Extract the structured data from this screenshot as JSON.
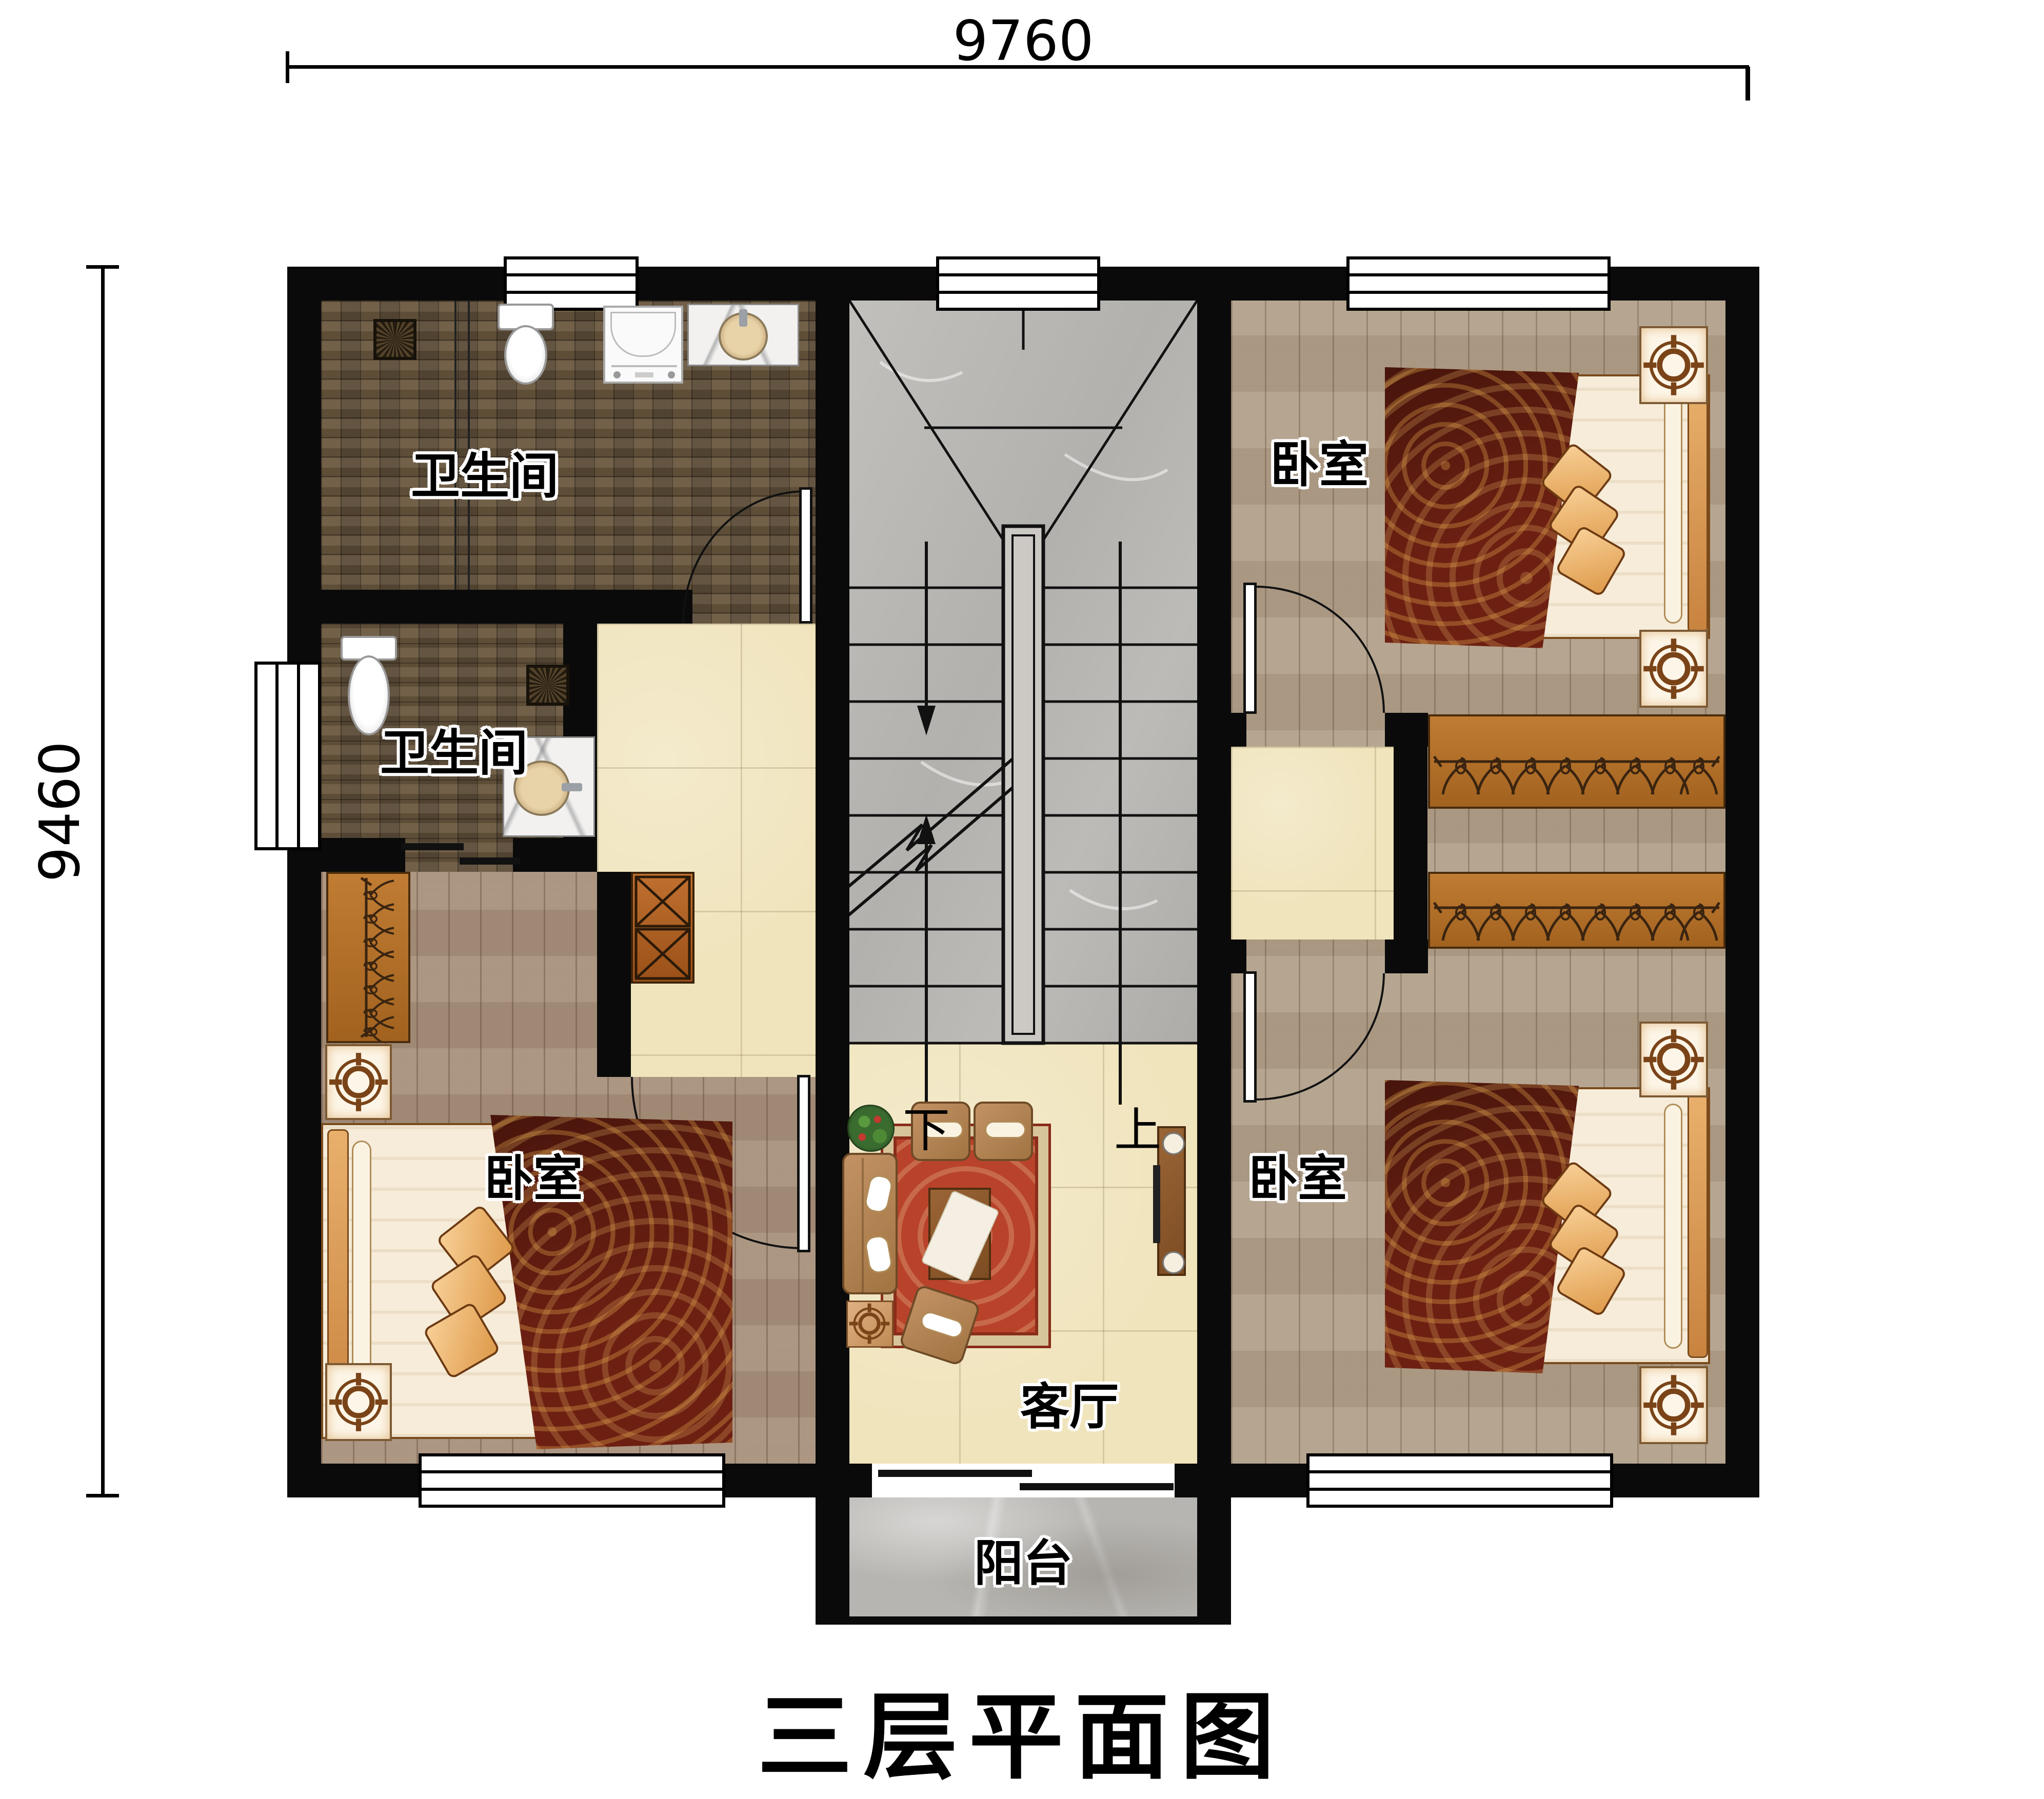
{
  "title": "三层平面图",
  "dimensions": {
    "width_label": "9760",
    "height_label": "9460"
  },
  "rooms": {
    "bathroom_top": {
      "label": "卫生间"
    },
    "bathroom_mid": {
      "label": "卫生间"
    },
    "bedroom_top_right": {
      "label": "卧室"
    },
    "bedroom_bottom_left": {
      "label": "卧室"
    },
    "bedroom_bottom_right": {
      "label": "卧室"
    },
    "living_room": {
      "label": "客厅"
    },
    "balcony": {
      "label": "阳台"
    }
  },
  "stairs": {
    "down_label": "下",
    "up_label": "上"
  },
  "icons": {
    "fixtures": [
      "toilet-icon",
      "sink-icon",
      "washing-machine-icon",
      "floor-drain-icon",
      "bed-icon",
      "nightstand-lamp-icon",
      "wardrobe-hanger-icon",
      "shoe-cabinet-icon",
      "sofa-icon",
      "coffee-table-icon",
      "tv-console-icon",
      "plant-icon",
      "stair-icon",
      "door-arc-icon",
      "window-icon"
    ]
  },
  "colors": {
    "wall": "#0a0a0a",
    "mosaic_floor": "#6e5c45",
    "wood_floor_left": "#a8917c",
    "wood_floor_right": "#b2a08a",
    "tile_floor": "#f0e4bc",
    "marble_floor": "#b7b5b1",
    "rug": "#b8432a",
    "bedspread": "#6d2012",
    "furniture_wood": "#b5762f",
    "fixture_white": "#ffffff"
  }
}
